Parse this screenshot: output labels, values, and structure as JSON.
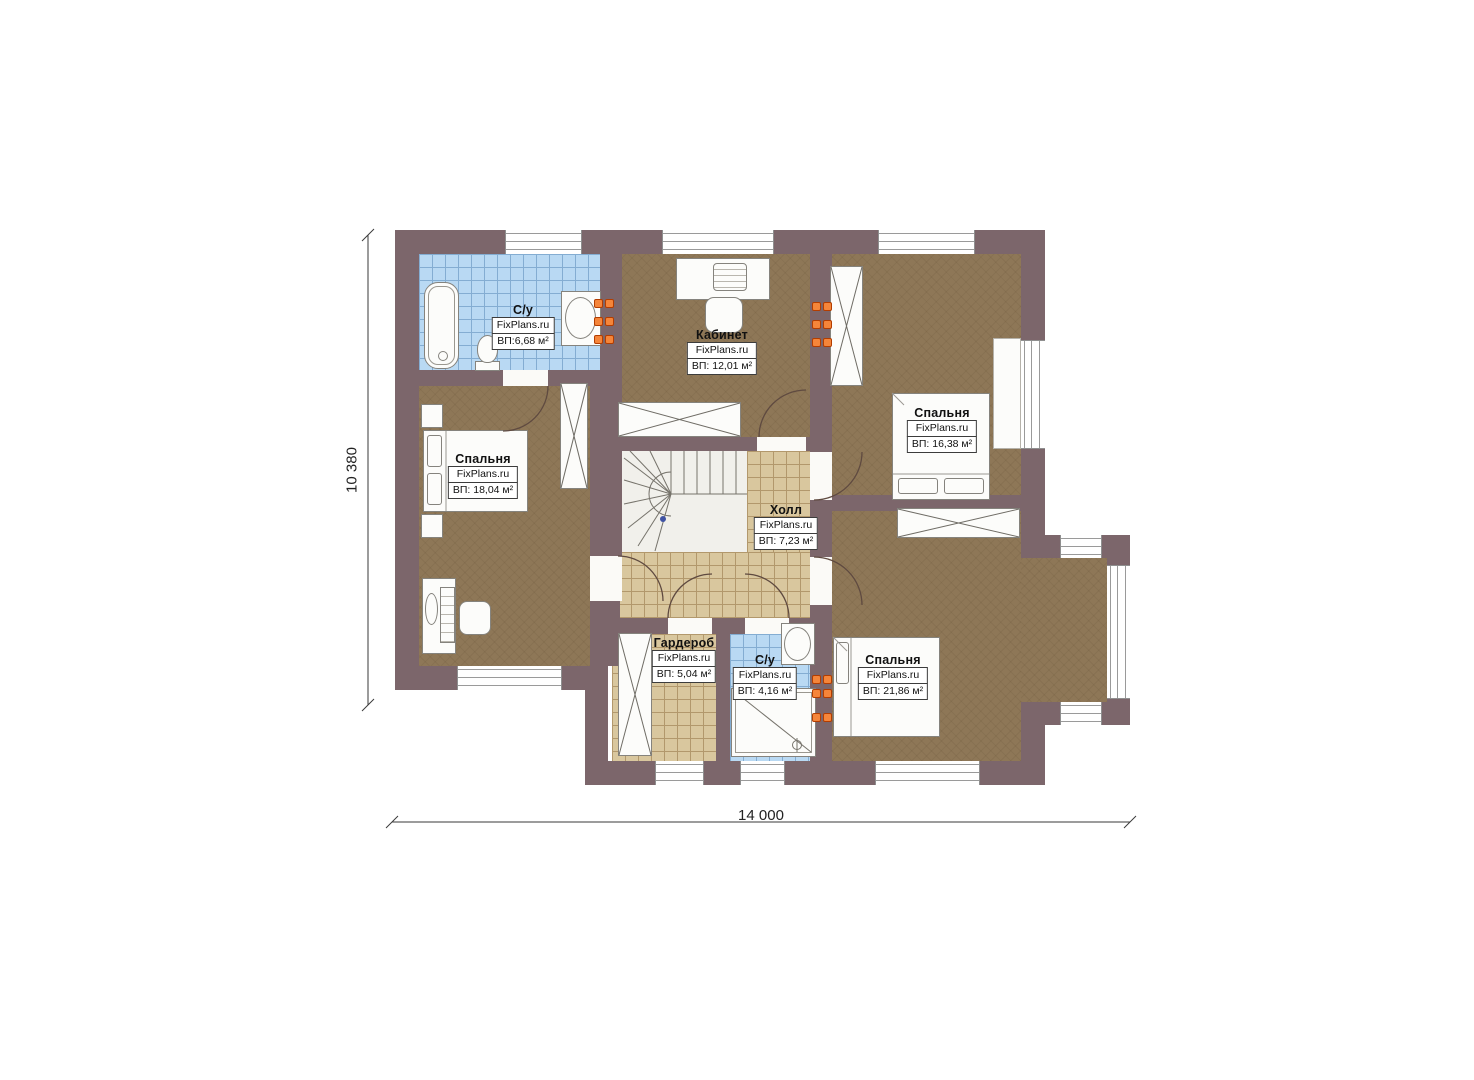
{
  "meta": {
    "type": "floor-plan",
    "floor": "second-floor"
  },
  "watermark": "FixPlans.ru",
  "rooms": [
    {
      "id": "bath-top",
      "name": "С/у",
      "area": "ВП:6,68 м²"
    },
    {
      "id": "office",
      "name": "Кабинет",
      "area": "ВП: 12,01 м²"
    },
    {
      "id": "bedroom-top-right",
      "name": "Спальня",
      "area": "ВП: 16,38 м²"
    },
    {
      "id": "bedroom-left",
      "name": "Спальня",
      "area": "ВП: 18,04 м²"
    },
    {
      "id": "hall",
      "name": "Холл",
      "area": "ВП: 7,23 м²"
    },
    {
      "id": "wardrobe",
      "name": "Гардероб",
      "area": "ВП: 5,04 м²"
    },
    {
      "id": "bath-bottom",
      "name": "С/у",
      "area": "ВП: 4,16 м²"
    },
    {
      "id": "bedroom-bottom-right",
      "name": "Спальня",
      "area": "ВП: 21,86 м²"
    }
  ],
  "dimensions": {
    "width_label": "14 000",
    "height_label": "10 380"
  },
  "colors": {
    "wall": "#7c666b",
    "wood_floor": "#8e7757",
    "tile_beige": "#d9c79e",
    "tile_blue": "#b9d9f3",
    "radiator_accent": "#f5853a"
  }
}
